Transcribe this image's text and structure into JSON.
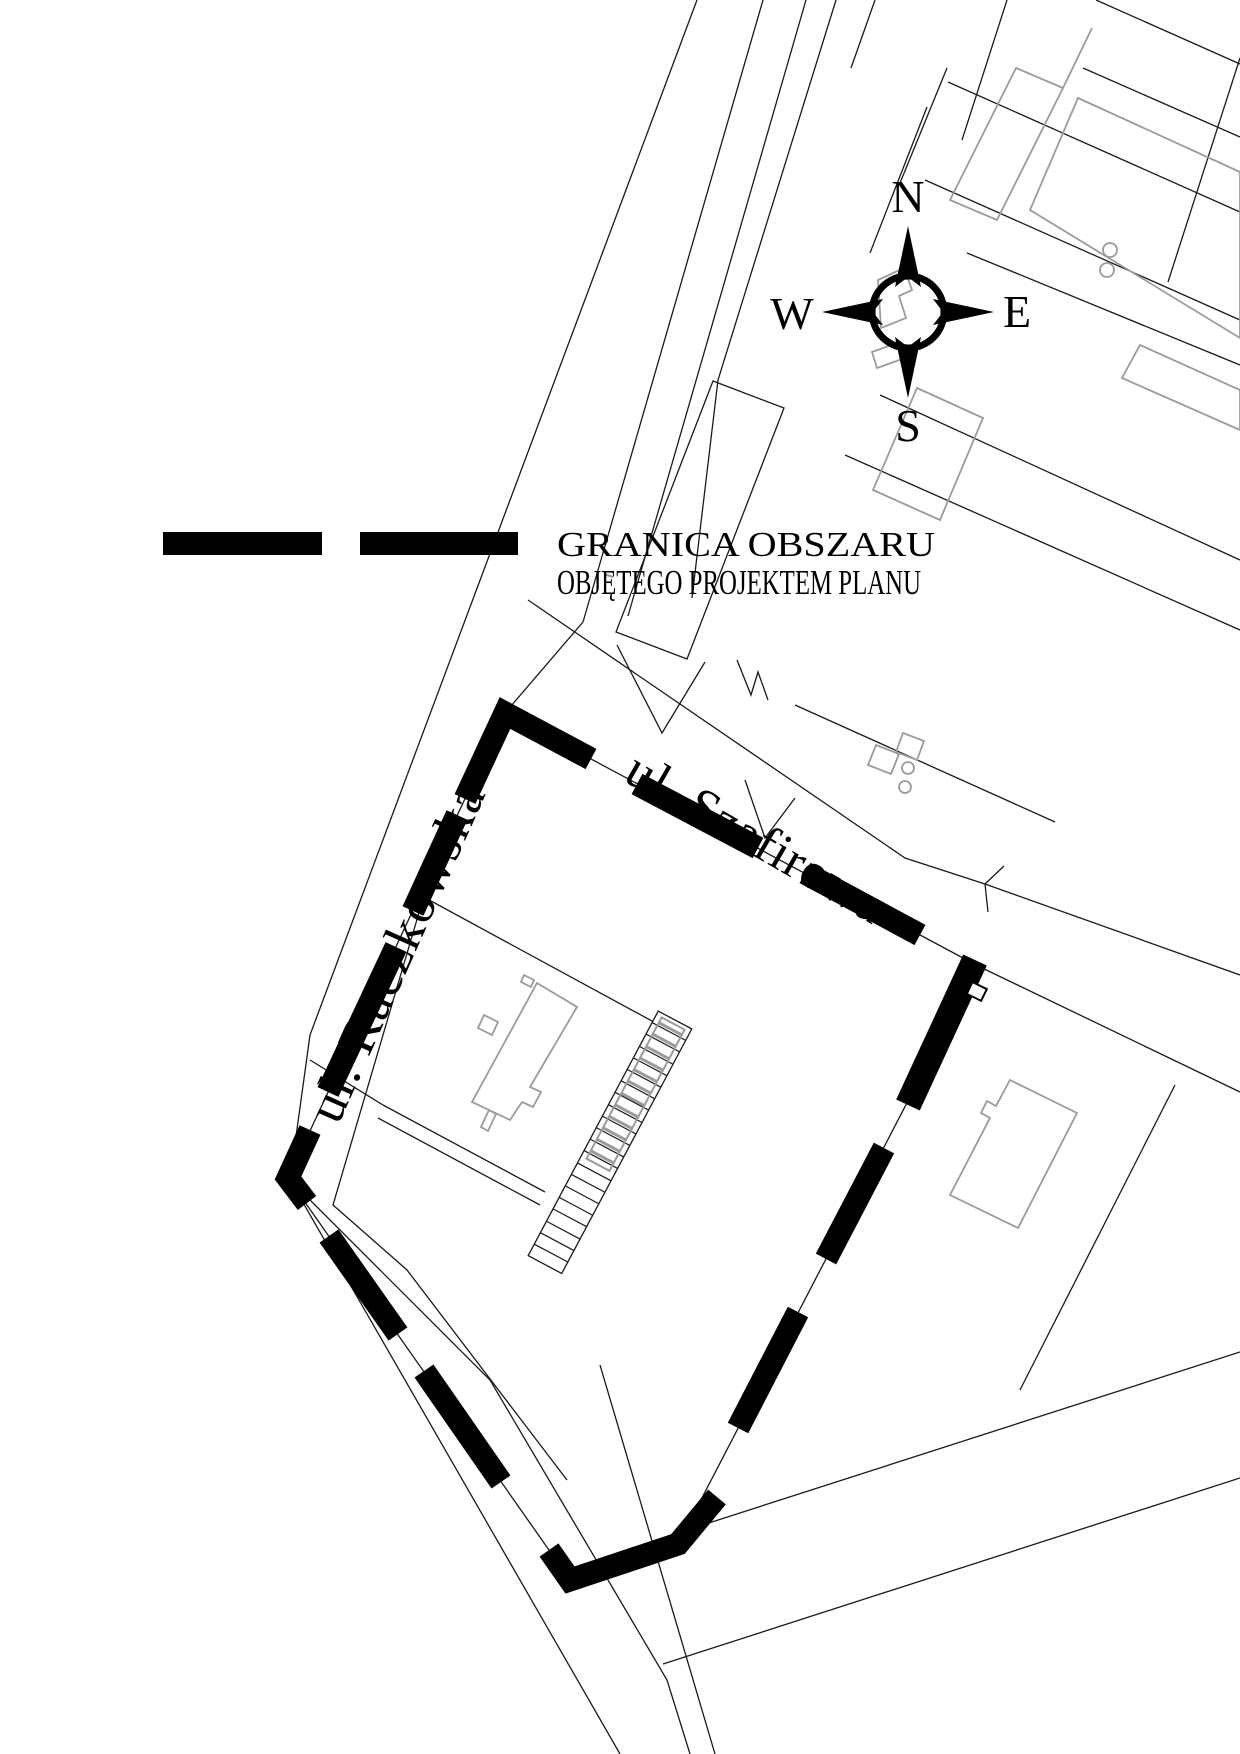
{
  "map": {
    "type": "cadastral plan excerpt",
    "compass": {
      "north": "N",
      "east": "E",
      "south": "S",
      "west": "W"
    },
    "legend": {
      "line1": "GRANICA OBSZARU",
      "line2": "OBJĘTEGO PROJEKTEM PLANU"
    },
    "streets": {
      "szafirowa": "ul. Szafirowa",
      "raczkowska": "ul. Raczkowska"
    },
    "colors": {
      "background": "#ffffff",
      "parcel_line": "#1a1a1a",
      "building_gray": "#9b9b9b",
      "boundary": "#000000"
    }
  }
}
